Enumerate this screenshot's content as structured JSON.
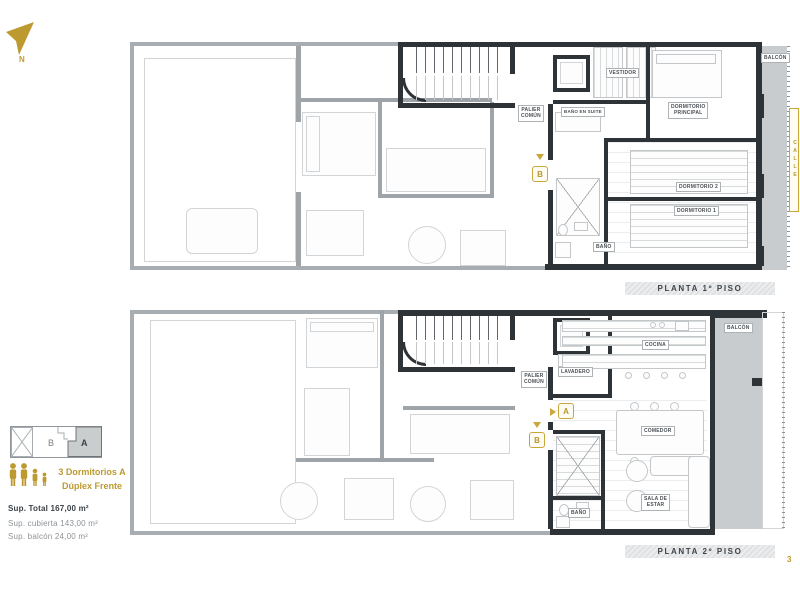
{
  "page": {
    "number": "3"
  },
  "colors": {
    "gold": "#BD9A30",
    "wall_dark": "#2E3337",
    "wall_gray": "#A7ADB0",
    "balcony_fill": "#C8CCCE",
    "band_text": "#3E4449",
    "muted_text": "#8E9498"
  },
  "compass": {
    "north": "N"
  },
  "floor1": {
    "title": "PLANTA 1º PISO",
    "balcony": "BALCÓN",
    "entrance_marker": "B",
    "rooms": {
      "palier": [
        "PALIER",
        "COMÚN"
      ],
      "vestidor": "VESTIDOR",
      "bano_en_suite": "BAÑO EN SUITE",
      "dormitorio_principal": [
        "DORMITORIO",
        "PRINCIPAL"
      ],
      "dormitorio_2": "DORMITORIO 2",
      "dormitorio_1": "DORMITORIO 1",
      "bano": "BAÑO"
    }
  },
  "floor2": {
    "title": "PLANTA 2º PISO",
    "balcony": "BALCÓN",
    "entrance_marker_a": "A",
    "entrance_marker_b": "B",
    "rooms": {
      "palier": [
        "PALIER",
        "COMÚN"
      ],
      "lavadero": "LAVADERO",
      "cocina": "COCINA",
      "comedor": "COMEDOR",
      "sala_de_estar": [
        "SALA DE",
        "ESTAR"
      ],
      "bano": "BAÑO"
    }
  },
  "street_label": "CALLE",
  "key_plan": {
    "unit_a": "A",
    "unit_b": "B"
  },
  "unit_info": {
    "icon": "family-icons",
    "title": [
      "3 Dormitorios A",
      "Dúplex Frente"
    ],
    "sup_total": "Sup. Total 167,00 m²",
    "sup_cubierta": "Sup. cubierta  143,00 m²",
    "sup_balcon": "Sup. balcón  24,00 m²"
  }
}
